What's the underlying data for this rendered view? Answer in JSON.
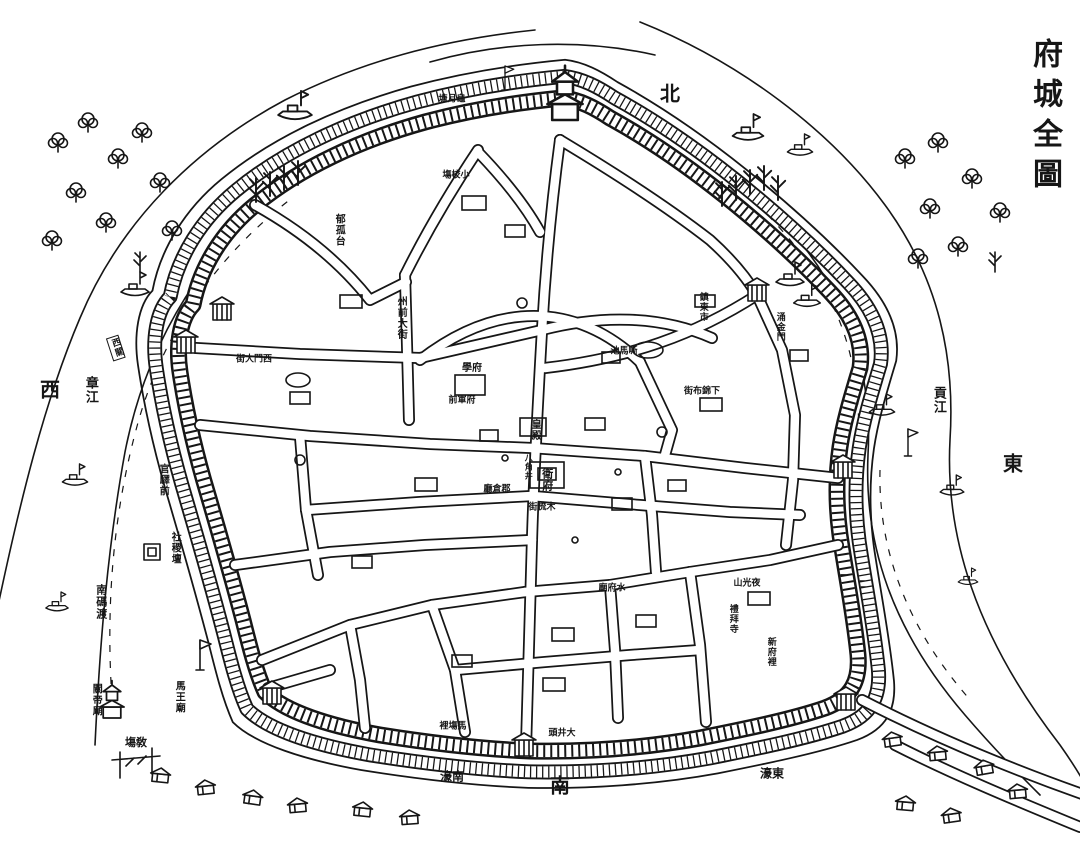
{
  "title": {
    "text": "府城全圖"
  },
  "colors": {
    "ink": "#161616",
    "paper": "#ffffff"
  },
  "map": {
    "labels": [
      {
        "name": "label-north",
        "text": "北",
        "x": 670,
        "y": 94,
        "o": "h",
        "size": 20
      },
      {
        "name": "label-west",
        "text": "西",
        "x": 50,
        "y": 390,
        "o": "h",
        "size": 20
      },
      {
        "name": "label-east",
        "text": "東",
        "x": 1013,
        "y": 464,
        "o": "h",
        "size": 20
      },
      {
        "name": "label-south",
        "text": "南",
        "x": 560,
        "y": 786,
        "o": "h",
        "size": 20
      },
      {
        "name": "label-zhang-river",
        "text": "章江",
        "x": 90,
        "y": 390,
        "o": "v",
        "size": 13
      },
      {
        "name": "label-gong-river",
        "text": "貢江",
        "x": 938,
        "y": 400,
        "o": "v",
        "size": 13
      },
      {
        "name": "label-south-ferry",
        "text": "南碼渡",
        "x": 101,
        "y": 602,
        "o": "v",
        "size": 11
      },
      {
        "name": "label-south-moat",
        "text": "濠南",
        "x": 452,
        "y": 777,
        "o": "h",
        "size": 12
      },
      {
        "name": "label-east-moat",
        "text": "濠東",
        "x": 772,
        "y": 774,
        "o": "h",
        "size": 12
      },
      {
        "name": "label-drill-ground",
        "text": "塲敎",
        "x": 136,
        "y": 743,
        "o": "h",
        "size": 11
      },
      {
        "name": "label-guandi-temple",
        "text": "關帝廟",
        "x": 95,
        "y": 700,
        "o": "v",
        "size": 10
      },
      {
        "name": "label-mawang-temple",
        "text": "馬王廟",
        "x": 178,
        "y": 697,
        "o": "v",
        "size": 10
      },
      {
        "name": "label-sheji-altar",
        "text": "社稷壇",
        "x": 174,
        "y": 548,
        "o": "v",
        "size": 10
      },
      {
        "name": "label-guanyi-qian",
        "text": "官驛前",
        "x": 162,
        "y": 480,
        "o": "v",
        "size": 10
      },
      {
        "name": "label-west-pass-flag",
        "text": "西關",
        "x": 116,
        "y": 348,
        "o": "v",
        "size": 9,
        "rot": -18,
        "boxed": true
      },
      {
        "name": "label-gui-yue-pond",
        "text": "塘月龜",
        "x": 452,
        "y": 100,
        "o": "h",
        "size": 9
      },
      {
        "name": "label-yugu-terrace",
        "text": "郁孤台",
        "x": 338,
        "y": 230,
        "o": "v",
        "size": 10
      },
      {
        "name": "label-zhouqian-street",
        "text": "州前大街",
        "x": 400,
        "y": 318,
        "o": "v",
        "size": 10
      },
      {
        "name": "label-west-gate-street",
        "text": "街大門西",
        "x": 254,
        "y": 360,
        "o": "h",
        "size": 9
      },
      {
        "name": "label-prefecture-school",
        "text": "學府",
        "x": 472,
        "y": 369,
        "o": "h",
        "size": 10
      },
      {
        "name": "label-fujun-qian",
        "text": "前軍府",
        "x": 462,
        "y": 401,
        "o": "h",
        "size": 9
      },
      {
        "name": "label-small-drill-field",
        "text": "塲校小",
        "x": 456,
        "y": 176,
        "o": "h",
        "size": 9
      },
      {
        "name": "label-sima-pond",
        "text": "池馬嘶",
        "x": 624,
        "y": 352,
        "o": "h",
        "size": 9
      },
      {
        "name": "label-guard-office",
        "text": "衛府",
        "x": 547,
        "y": 480,
        "o": "v",
        "size": 11
      },
      {
        "name": "label-eight-corner-well",
        "text": "八角井",
        "x": 529,
        "y": 467,
        "o": "v",
        "size": 8
      },
      {
        "name": "label-granary-hall",
        "text": "廳倉郡",
        "x": 497,
        "y": 490,
        "o": "h",
        "size": 9
      },
      {
        "name": "label-mushu-street",
        "text": "街梳木",
        "x": 542,
        "y": 508,
        "o": "h",
        "size": 9
      },
      {
        "name": "label-imperial-hall",
        "text": "皇殿",
        "x": 534,
        "y": 430,
        "o": "v",
        "size": 10
      },
      {
        "name": "label-xiajinbu-street",
        "text": "街布錦下",
        "x": 702,
        "y": 392,
        "o": "h",
        "size": 9
      },
      {
        "name": "label-zhendong-market",
        "text": "鎮東市",
        "x": 702,
        "y": 307,
        "o": "v",
        "size": 9
      },
      {
        "name": "label-yongjin-gate",
        "text": "涌金門",
        "x": 779,
        "y": 327,
        "o": "v",
        "size": 9
      },
      {
        "name": "label-yeguang-hill",
        "text": "山光夜",
        "x": 747,
        "y": 584,
        "o": "h",
        "size": 9
      },
      {
        "name": "label-shuifu-temple",
        "text": "廟府水",
        "x": 612,
        "y": 589,
        "o": "h",
        "size": 9
      },
      {
        "name": "label-xinfu-li",
        "text": "新府裡",
        "x": 770,
        "y": 652,
        "o": "v",
        "size": 9
      },
      {
        "name": "label-libai-mosque",
        "text": "禮拜寺",
        "x": 732,
        "y": 619,
        "o": "v",
        "size": 9
      },
      {
        "name": "label-machang-li",
        "text": "裡塲馬",
        "x": 453,
        "y": 727,
        "o": "h",
        "size": 9
      },
      {
        "name": "label-big-well-head",
        "text": "頭井大",
        "x": 562,
        "y": 734,
        "o": "h",
        "size": 9
      }
    ],
    "symbols": [
      {
        "ref": "boat",
        "x": 295,
        "y": 115,
        "s": 1.2
      },
      {
        "ref": "boat",
        "x": 135,
        "y": 292,
        "s": 1
      },
      {
        "ref": "boat",
        "x": 75,
        "y": 482,
        "s": 0.9
      },
      {
        "ref": "boat",
        "x": 57,
        "y": 608,
        "s": 0.8
      },
      {
        "ref": "boat",
        "x": 748,
        "y": 136,
        "s": 1.1
      },
      {
        "ref": "boat",
        "x": 800,
        "y": 152,
        "s": 0.9
      },
      {
        "ref": "boat",
        "x": 790,
        "y": 282,
        "s": 1
      },
      {
        "ref": "boat",
        "x": 807,
        "y": 303,
        "s": 0.95
      },
      {
        "ref": "boat",
        "x": 882,
        "y": 412,
        "s": 0.9
      },
      {
        "ref": "boat",
        "x": 952,
        "y": 492,
        "s": 0.85
      },
      {
        "ref": "boat",
        "x": 968,
        "y": 582,
        "s": 0.7
      },
      {
        "ref": "tree1",
        "x": 58,
        "y": 152
      },
      {
        "ref": "tree1",
        "x": 88,
        "y": 132
      },
      {
        "ref": "tree1",
        "x": 118,
        "y": 168
      },
      {
        "ref": "tree1",
        "x": 76,
        "y": 202
      },
      {
        "ref": "tree1",
        "x": 142,
        "y": 142
      },
      {
        "ref": "tree1",
        "x": 160,
        "y": 192
      },
      {
        "ref": "tree1",
        "x": 106,
        "y": 232
      },
      {
        "ref": "tree1",
        "x": 52,
        "y": 250
      },
      {
        "ref": "tree1",
        "x": 172,
        "y": 240
      },
      {
        "ref": "tree1",
        "x": 905,
        "y": 168
      },
      {
        "ref": "tree1",
        "x": 938,
        "y": 152
      },
      {
        "ref": "tree1",
        "x": 972,
        "y": 188
      },
      {
        "ref": "tree1",
        "x": 930,
        "y": 218
      },
      {
        "ref": "tree1",
        "x": 1000,
        "y": 222
      },
      {
        "ref": "tree1",
        "x": 958,
        "y": 256
      },
      {
        "ref": "tree1",
        "x": 918,
        "y": 268
      },
      {
        "ref": "tree2",
        "x": 140,
        "y": 272
      },
      {
        "ref": "tree2",
        "x": 995,
        "y": 272
      },
      {
        "ref": "tree2",
        "x": 256,
        "y": 202,
        "s": 1.2
      },
      {
        "ref": "tree2",
        "x": 270,
        "y": 196,
        "s": 1.2
      },
      {
        "ref": "tree2",
        "x": 284,
        "y": 190,
        "s": 1.2
      },
      {
        "ref": "tree2",
        "x": 298,
        "y": 185,
        "s": 1.2
      },
      {
        "ref": "tree2",
        "x": 722,
        "y": 206,
        "s": 1.2
      },
      {
        "ref": "tree2",
        "x": 736,
        "y": 200,
        "s": 1.2
      },
      {
        "ref": "tree2",
        "x": 750,
        "y": 194,
        "s": 1.2
      },
      {
        "ref": "tree2",
        "x": 764,
        "y": 190,
        "s": 1.2
      },
      {
        "ref": "tree2",
        "x": 778,
        "y": 200,
        "s": 1.2
      },
      {
        "ref": "house",
        "x": 893,
        "y": 744,
        "r": -8
      },
      {
        "ref": "house",
        "x": 938,
        "y": 758,
        "r": -5
      },
      {
        "ref": "house",
        "x": 985,
        "y": 772,
        "r": -10
      },
      {
        "ref": "house",
        "x": 1018,
        "y": 796,
        "r": -5
      },
      {
        "ref": "house",
        "x": 905,
        "y": 808,
        "r": 5
      },
      {
        "ref": "house",
        "x": 952,
        "y": 820,
        "r": -8
      },
      {
        "ref": "house",
        "x": 160,
        "y": 780,
        "r": 6
      },
      {
        "ref": "house",
        "x": 206,
        "y": 792,
        "r": -6
      },
      {
        "ref": "house",
        "x": 252,
        "y": 802,
        "r": 8
      },
      {
        "ref": "house",
        "x": 298,
        "y": 810,
        "r": -5
      },
      {
        "ref": "house",
        "x": 362,
        "y": 814,
        "r": 6
      },
      {
        "ref": "house",
        "x": 410,
        "y": 822,
        "r": -4
      },
      {
        "ref": "gate",
        "x": 186,
        "y": 345
      },
      {
        "ref": "gate",
        "x": 222,
        "y": 312
      },
      {
        "ref": "gate",
        "x": 272,
        "y": 696
      },
      {
        "ref": "gate",
        "x": 524,
        "y": 748
      },
      {
        "ref": "gate",
        "x": 846,
        "y": 702
      },
      {
        "ref": "gate",
        "x": 757,
        "y": 293
      },
      {
        "ref": "gate",
        "x": 843,
        "y": 470
      },
      {
        "ref": "pagoda",
        "x": 565,
        "y": 120,
        "s": 1.6
      },
      {
        "ref": "pagoda",
        "x": 112,
        "y": 718,
        "s": 1.1
      },
      {
        "ref": "flagpole",
        "x": 200,
        "y": 670
      },
      {
        "ref": "flagpole",
        "x": 908,
        "y": 456,
        "s": 0.9
      },
      {
        "ref": "flagpole",
        "x": 505,
        "y": 90,
        "s": 0.8
      },
      {
        "ref": "altar",
        "x": 152,
        "y": 552
      }
    ]
  }
}
